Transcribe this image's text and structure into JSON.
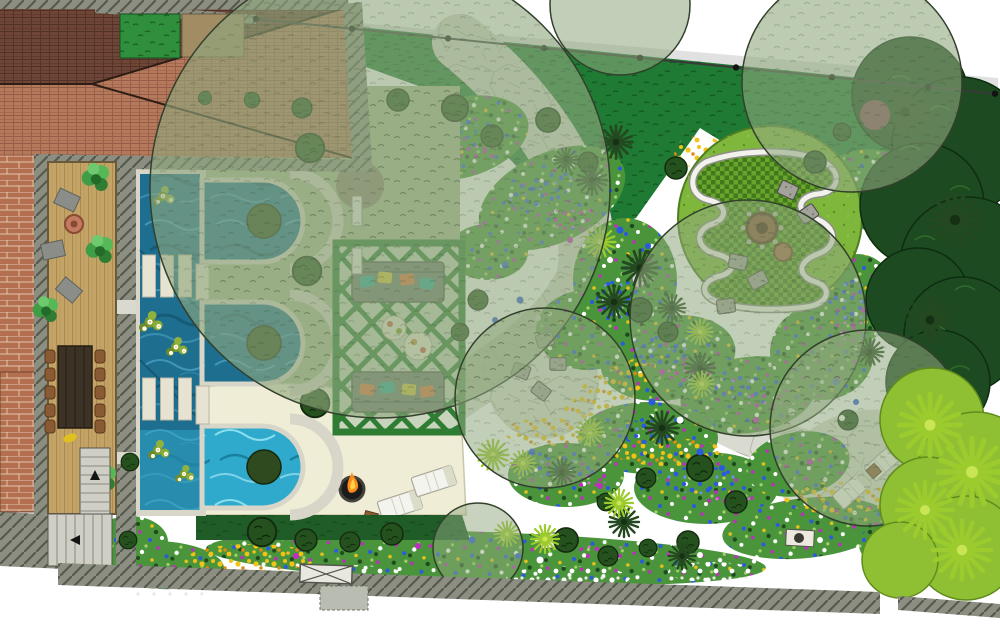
{
  "title": "Residential garden landscape masterplan (top-down rendered site plan)",
  "palette": {
    "roof_tile": "#b5795b",
    "roof_dark": "#6e4536",
    "wall_gray": "#8b8e81",
    "brick": "#b46f50",
    "deck_wood": "#c4a466",
    "table_wood": "#3d3226",
    "chair_wood": "#8a5a34",
    "water_dark": "#1e6e90",
    "water_bright": "#2fa9cc",
    "coping": "#d8d6c8",
    "lawn_dark": "#1f7a33",
    "lawn_bright": "#7fb63c",
    "parterre_dark": "#3f7a1c",
    "canopy": "#8fa87e",
    "patio_cream": "#f0edd6",
    "path_stone": "#d9dbd0",
    "bed_green": "#4a943b",
    "hedge": "#1f5c28",
    "flower_blue": "#2a5adf",
    "flower_magenta": "#c12cc1",
    "flower_yellow": "#e8c21c",
    "flower_white": "#ffffff",
    "trellis_green": "#2e7d32",
    "sofa_gray": "#6f7a6e",
    "cushion_teal": "#2aa79b",
    "cushion_orange": "#e2713d",
    "cushion_yellow": "#d9c33c",
    "bench_white": "#f2f2ec",
    "stone_seat": "#a3a39b",
    "firepit_brown": "#8a5a3a",
    "flame_orange": "#ff8c1a",
    "palm_dark": "#24481f",
    "grass_chartreuse": "#9ccb2e",
    "tree_dark": "#1d4a20",
    "tree_bright": "#8fbf33",
    "fence_line": "#3a3a3a",
    "lounger_white": "#f4f4ee"
  },
  "features": {
    "house": "terracotta hip roof with grey parapet walls",
    "deck": "timber deck with dining table, side chairs, lounge cushions and fire bowl",
    "water_feature": "formal rill with three arched reflection basins and planted islands",
    "stepping_stones": "two groups of three slabs crossing the rill",
    "water_lilies": "five lily clusters with white flowers",
    "pergola": "green trellis pergola with two outdoor sofas and round coffee tables",
    "patio": "cream resin-bound patio with sunken fire pit and two sun loungers",
    "parterre": "circular lawn with serpentine white bench, chequer parterre, fire pit and stone seat cushions",
    "planting": "mixed perennial borders with blue, white, magenta and yellow drifts, palms and ornamental grasses",
    "paths": "winding crazy-paved stone paths with circular seating plaza",
    "boundary": "post-and-wire fence to rear, rendered walls with gate to front, evergreen screen to east"
  },
  "counts": {
    "arched_basins": 3,
    "stepping_stones": 6,
    "fence_posts": 9,
    "sofas": 2,
    "stone_seats": 5,
    "sun_loungers": 2,
    "fire_pits": 2,
    "stair_flights": 2
  }
}
